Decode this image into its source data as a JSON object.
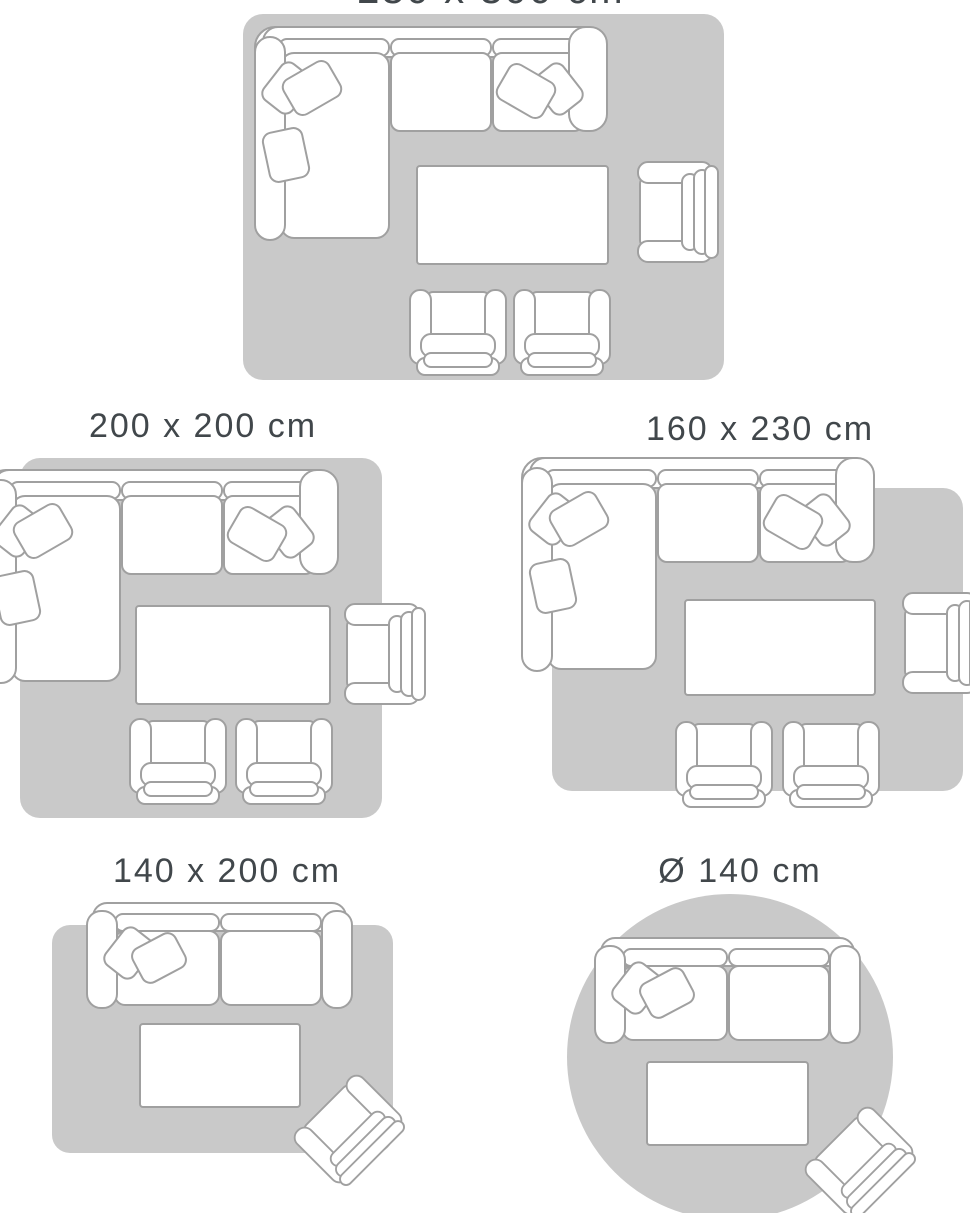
{
  "colors": {
    "rug_fill": "#c9c9c9",
    "furniture_fill": "#ffffff",
    "furniture_outline": "#a0a0a0",
    "label_text": "#41474b",
    "background": "#ffffff"
  },
  "size_guide": {
    "layouts": [
      {
        "size_label": "230 x 300 cm",
        "rug_shape": "rectangle",
        "furniture_icons": [
          "corner-sofa-icon",
          "pillow-icon",
          "coffee-table-icon",
          "armchair-icon",
          "club-chair-icon",
          "club-chair-icon"
        ]
      },
      {
        "size_label": "200 x 200 cm",
        "rug_shape": "square",
        "furniture_icons": [
          "corner-sofa-icon",
          "pillow-icon",
          "coffee-table-icon",
          "armchair-icon",
          "club-chair-icon",
          "club-chair-icon"
        ]
      },
      {
        "size_label": "160 x 230 cm",
        "rug_shape": "rectangle",
        "furniture_icons": [
          "corner-sofa-icon",
          "pillow-icon",
          "coffee-table-icon",
          "armchair-icon",
          "club-chair-icon",
          "club-chair-icon"
        ]
      },
      {
        "size_label": "140 x 200 cm",
        "rug_shape": "rectangle",
        "furniture_icons": [
          "two-seat-sofa-icon",
          "pillow-icon",
          "coffee-table-icon",
          "armchair-icon"
        ]
      },
      {
        "size_label": "Ø 140 cm",
        "rug_shape": "round",
        "furniture_icons": [
          "two-seat-sofa-icon",
          "pillow-icon",
          "coffee-table-icon",
          "armchair-icon"
        ]
      }
    ]
  }
}
